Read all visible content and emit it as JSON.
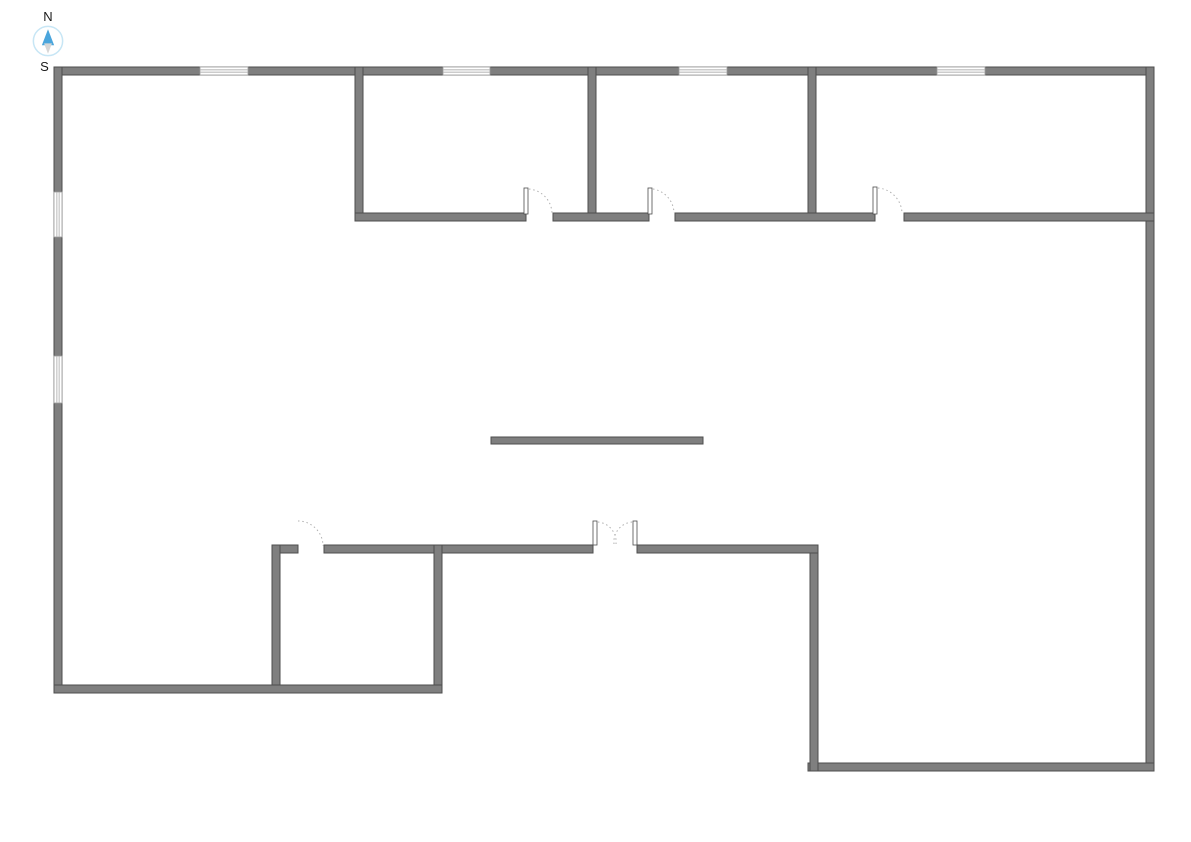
{
  "canvas": {
    "width": 1191,
    "height": 842,
    "background": "#ffffff"
  },
  "colors": {
    "wall_fill": "#7f7f7f",
    "wall_stroke": "#4d4d4d",
    "window_fill": "#ffffff",
    "window_stroke": "#9a9a9a",
    "door_arc": "#b0b0b0",
    "door_leaf_fill": "#ffffff",
    "door_leaf_stroke": "#4d4d4d",
    "compass_ring": "#c7e6f5",
    "compass_north": "#4aa5dc",
    "compass_south": "#d6d6d6",
    "label_color": "#1a1a1a"
  },
  "compass": {
    "north_label": "N",
    "south_label": "S"
  },
  "walls": [
    {
      "name": "exterior-top-wall",
      "x": 54,
      "y": 67,
      "w": 1100,
      "h": 8
    },
    {
      "name": "exterior-left-wall",
      "x": 54,
      "y": 67,
      "w": 8,
      "h": 626
    },
    {
      "name": "exterior-right-wall",
      "x": 1146,
      "y": 67,
      "w": 8,
      "h": 704
    },
    {
      "name": "exterior-bottom-right-wall",
      "x": 808,
      "y": 763,
      "w": 346,
      "h": 8
    },
    {
      "name": "notch-vertical-wall",
      "x": 810,
      "y": 545,
      "w": 8,
      "h": 226
    },
    {
      "name": "mid-wall-left-stub",
      "x": 272,
      "y": 545,
      "w": 26,
      "h": 8
    },
    {
      "name": "mid-wall-center",
      "x": 324,
      "y": 545,
      "w": 269,
      "h": 8
    },
    {
      "name": "mid-wall-right",
      "x": 637,
      "y": 545,
      "w": 181,
      "h": 8
    },
    {
      "name": "lower-room-left-wall",
      "x": 272,
      "y": 545,
      "w": 8,
      "h": 148
    },
    {
      "name": "lower-room-right-wall",
      "x": 434,
      "y": 545,
      "w": 8,
      "h": 148
    },
    {
      "name": "exterior-bottom-left-wall",
      "x": 54,
      "y": 685,
      "w": 388,
      "h": 8
    },
    {
      "name": "top-room-1-left-wall",
      "x": 355,
      "y": 67,
      "w": 8,
      "h": 154
    },
    {
      "name": "top-room-divider-1",
      "x": 588,
      "y": 67,
      "w": 8,
      "h": 154
    },
    {
      "name": "top-room-divider-2",
      "x": 808,
      "y": 67,
      "w": 8,
      "h": 154
    },
    {
      "name": "top-rooms-bottom-wall-1",
      "x": 355,
      "y": 213,
      "w": 171,
      "h": 8
    },
    {
      "name": "top-rooms-bottom-wall-2",
      "x": 553,
      "y": 213,
      "w": 96,
      "h": 8
    },
    {
      "name": "top-rooms-bottom-wall-3",
      "x": 675,
      "y": 213,
      "w": 200,
      "h": 8
    },
    {
      "name": "top-rooms-bottom-wall-4",
      "x": 904,
      "y": 213,
      "w": 250,
      "h": 8
    },
    {
      "name": "freestanding-island-wall",
      "x": 491,
      "y": 437,
      "w": 212,
      "h": 7
    }
  ],
  "windows": [
    {
      "name": "window-top-1",
      "x": 200,
      "y": 67,
      "w": 48,
      "h": 8,
      "orientation": "horizontal"
    },
    {
      "name": "window-top-2",
      "x": 443,
      "y": 67,
      "w": 47,
      "h": 8,
      "orientation": "horizontal"
    },
    {
      "name": "window-top-3",
      "x": 679,
      "y": 67,
      "w": 48,
      "h": 8,
      "orientation": "horizontal"
    },
    {
      "name": "window-top-4",
      "x": 937,
      "y": 67,
      "w": 48,
      "h": 8,
      "orientation": "horizontal"
    },
    {
      "name": "window-left-1",
      "x": 54,
      "y": 192,
      "w": 8,
      "h": 45,
      "orientation": "vertical"
    },
    {
      "name": "window-left-2",
      "x": 54,
      "y": 356,
      "w": 8,
      "h": 47,
      "orientation": "vertical"
    }
  ],
  "doors": [
    {
      "name": "door-top-room-1",
      "leaves": [
        {
          "x": 524,
          "y": 188,
          "w": 4,
          "h": 26
        }
      ],
      "arcs": [
        "M 529 189 A 25 25 0 0 1 552 213"
      ]
    },
    {
      "name": "door-top-room-2",
      "leaves": [
        {
          "x": 648,
          "y": 188,
          "w": 4,
          "h": 26
        }
      ],
      "arcs": [
        "M 653 189 A 25 25 0 0 1 674 213"
      ]
    },
    {
      "name": "door-top-room-3",
      "leaves": [
        {
          "x": 873,
          "y": 187,
          "w": 4,
          "h": 27
        }
      ],
      "arcs": [
        "M 878 188 A 26 26 0 0 1 902 213"
      ]
    },
    {
      "name": "door-lower-room",
      "leaves": [],
      "arcs": [
        "M 298 521 A 25 25 0 0 1 323 546"
      ]
    },
    {
      "name": "double-door-main",
      "leaves": [
        {
          "x": 593,
          "y": 521,
          "w": 4,
          "h": 24
        },
        {
          "x": 633,
          "y": 521,
          "w": 4,
          "h": 24
        }
      ],
      "arcs": [
        "M 598 522 A 20 20 0 0 1 616 544",
        "M 632 522 A 20 20 0 0 0 614 544"
      ]
    }
  ]
}
